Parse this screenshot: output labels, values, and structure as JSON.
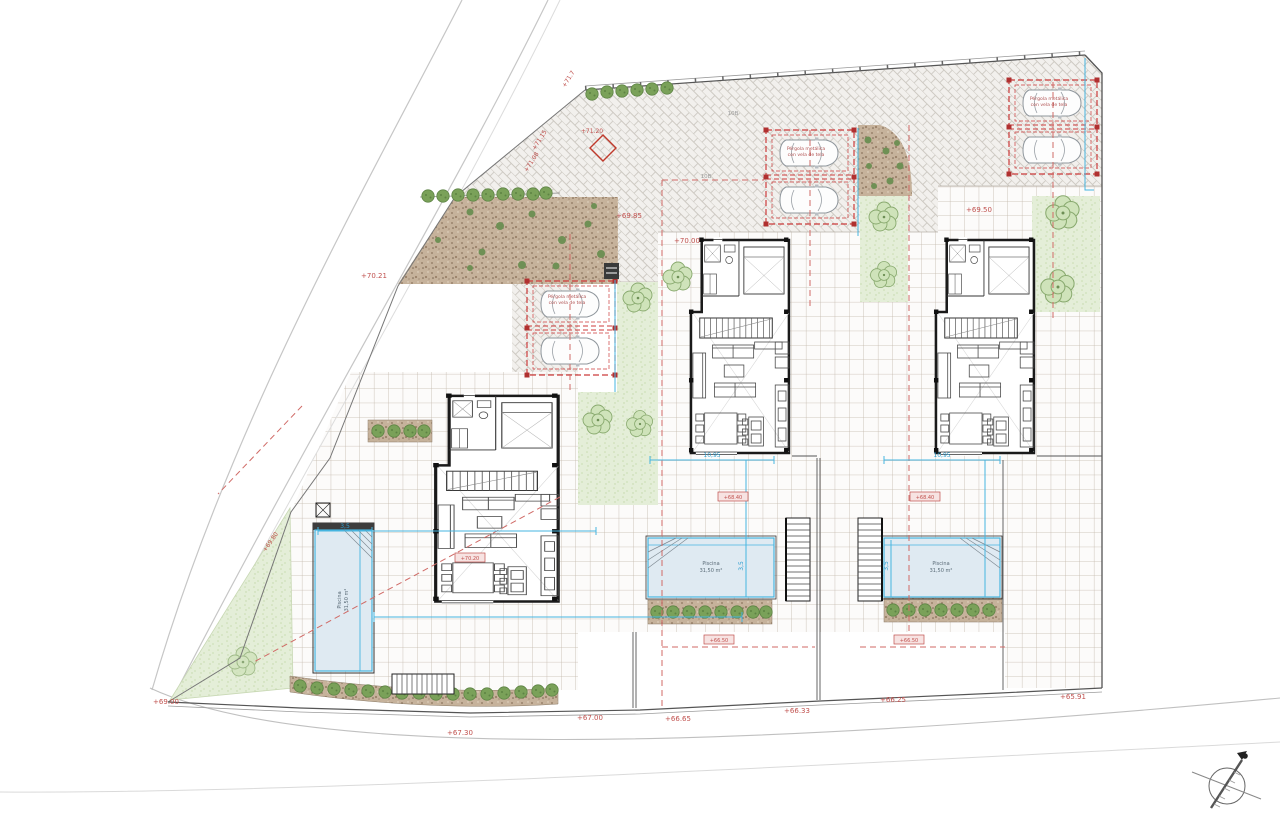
{
  "drawing": {
    "pool_label": {
      "line1": "Piscina",
      "line2": "31,50 m²"
    },
    "pergola_label": {
      "line1": "Pérgola metálica",
      "line2": "con vela de tela"
    },
    "parcel_marks": [
      {
        "text": "10B"
      },
      {
        "text": "10B"
      }
    ],
    "elevation_labels": [
      {
        "text": "+71.7"
      },
      {
        "text": "+71.15"
      },
      {
        "text": "+71.20"
      },
      {
        "text": "+71.08"
      },
      {
        "text": "+70.21"
      },
      {
        "text": "+69.85"
      },
      {
        "text": "+70.00"
      },
      {
        "text": "+69.50"
      },
      {
        "text": "+69.80"
      },
      {
        "text": "+69.00"
      },
      {
        "text": "+67.30"
      },
      {
        "text": "+67.00"
      },
      {
        "text": "+66.65"
      },
      {
        "text": "+66.33"
      },
      {
        "text": "+66.25"
      },
      {
        "text": "+65.91"
      }
    ],
    "level_boxes": [
      {
        "text": "+70.20"
      },
      {
        "text": "+68.40"
      },
      {
        "text": "+68.40"
      },
      {
        "text": "+66.50"
      },
      {
        "text": "+66.50"
      }
    ],
    "dimensions": [
      {
        "text": "3,5"
      },
      {
        "text": "10,95"
      },
      {
        "text": "10,95"
      },
      {
        "text": "3,5"
      },
      {
        "text": "3,5"
      }
    ],
    "colors": {
      "annotation_red": "#c0504d",
      "dimension_blue": "#2f9fd0",
      "pool_border": "#46b5e0",
      "pergola_red": "#cc3b3b",
      "hedge_brown": "#c9b7a2",
      "garden_green": "#e4eed8"
    }
  }
}
